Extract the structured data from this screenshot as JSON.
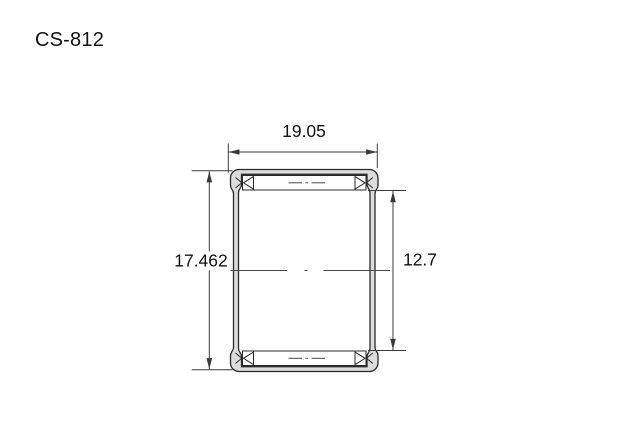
{
  "title": "CS-812",
  "dimensions": {
    "outer_width": "19.05",
    "outer_height": "17.462",
    "bore_diameter": "12.7"
  },
  "colors": {
    "background": "#ffffff",
    "drawing_line": "#2b2b2b",
    "dimension_line": "#3a3a3a",
    "shell_fill": "#dcdcdc",
    "text": "#111111"
  }
}
